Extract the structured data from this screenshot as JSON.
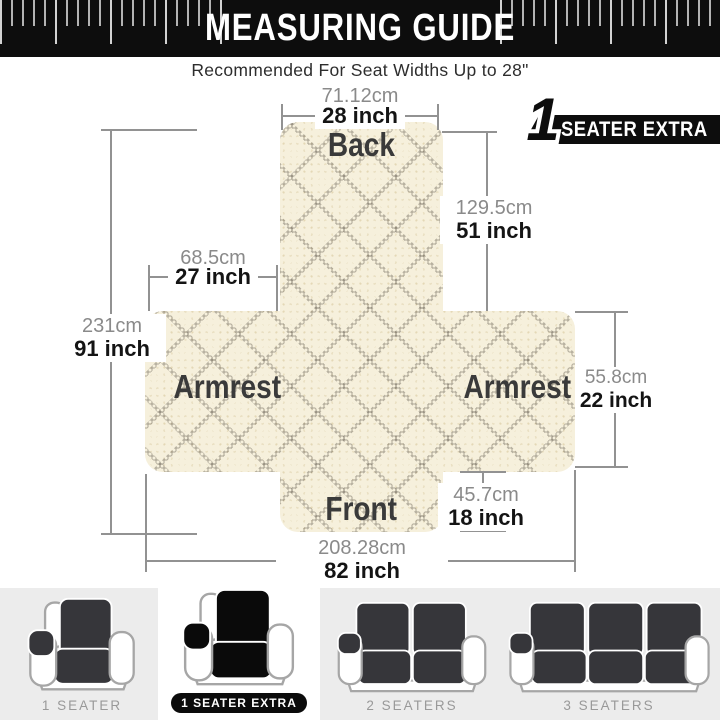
{
  "header": {
    "title": "MEASURING GUIDE",
    "subtitle": "Recommended For Seat Widths Up to 28\""
  },
  "badge": {
    "number": "1",
    "label": "SEATER EXTRA"
  },
  "diagram": {
    "labels": {
      "back": "Back",
      "armrest_left": "Armrest",
      "armrest_right": "Armrest",
      "front": "Front"
    },
    "measurements": {
      "top_width": {
        "cm": "71.12cm",
        "inch": "28 inch"
      },
      "back_length": {
        "cm": "129.5cm",
        "inch": "51 inch"
      },
      "armrest_width": {
        "cm": "68.5cm",
        "inch": "27 inch"
      },
      "total_length": {
        "cm": "231cm",
        "inch": "91 inch"
      },
      "armrest_height": {
        "cm": "55.8cm",
        "inch": "22 inch"
      },
      "front_length": {
        "cm": "45.7cm",
        "inch": "18 inch"
      },
      "total_width": {
        "cm": "208.28cm",
        "inch": "82 inch"
      }
    }
  },
  "variants": [
    {
      "label": "1 SEATER",
      "selected": false,
      "type": "recliner"
    },
    {
      "label": "1 SEATER EXTRA",
      "selected": true,
      "type": "recliner"
    },
    {
      "label": "2 SEATERS",
      "selected": false,
      "type": "loveseat"
    },
    {
      "label": "3 SEATERS",
      "selected": false,
      "type": "sofa"
    }
  ],
  "colors": {
    "header_bg": "#0d0d0d",
    "title_text": "#ffffff",
    "subtitle_text": "#2d2d2d",
    "badge_bg": "#0d0d0d",
    "badge_text": "#ffffff",
    "fabric_base": "#f6f0dc",
    "fabric_label": "#3a3a3a",
    "measure_line": "#929292",
    "cm_text": "#8a8a8a",
    "inch_text": "#141414",
    "strip_bg": "#ececec",
    "strip_selected_bg": "#ffffff",
    "variant_label": "#999999",
    "cover_dark": "#36363a",
    "cover_selected": "#0a0a0a"
  }
}
